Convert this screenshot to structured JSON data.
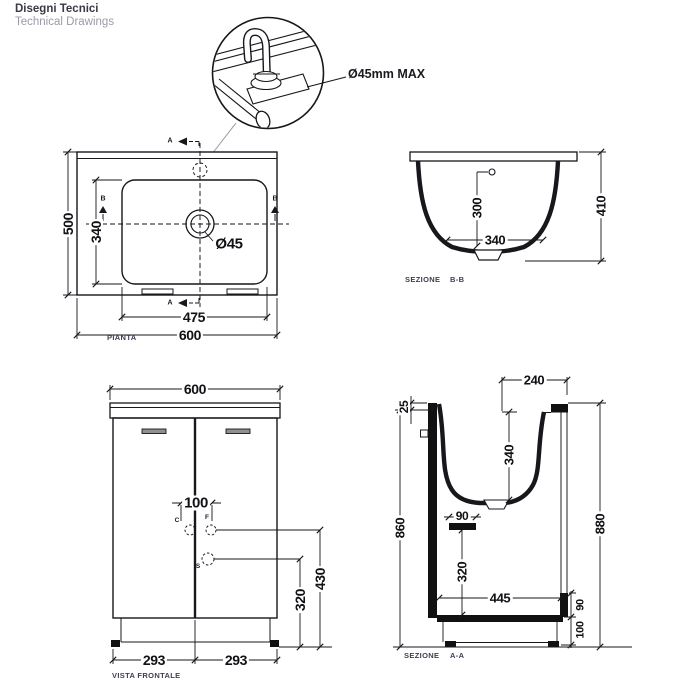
{
  "header": {
    "title_primary": "Disegni Tecnici",
    "title_secondary": "Technical Drawings"
  },
  "detail_callout": {
    "label": "Ø45mm MAX"
  },
  "plan_view": {
    "caption": "PIANTA",
    "marker_a": "A",
    "marker_b": "B",
    "dim_outer_width": "600",
    "dim_inner_width": "475",
    "dim_outer_depth": "500",
    "dim_inner_depth": "340",
    "dim_drain": "Ø45"
  },
  "section_bb": {
    "caption": "SEZIONE",
    "ref": "B-B",
    "dim_overflow_height": "300",
    "dim_bottom_width": "340",
    "dim_total_height": "410"
  },
  "front_view": {
    "caption": "VISTA FRONTALE",
    "dim_width": "600",
    "dim_hole_spacing": "100",
    "dim_upper_holes_height": "430",
    "dim_lower_hole_height": "320",
    "dim_door_left": "293",
    "dim_door_right": "293",
    "hole_c": "C",
    "hole_f": "F",
    "hole_s": "S"
  },
  "section_aa": {
    "caption": "SEZIONE",
    "ref": "A-A",
    "dim_top_width": "240",
    "dim_rim": "25",
    "dim_basin_depth": "340",
    "dim_drain_width": "90",
    "dim_drain_height": "320",
    "dim_inner_width": "445",
    "dim_front_height": "860",
    "dim_back_height": "880",
    "dim_back_gap": "90",
    "dim_plinth": "100"
  }
}
